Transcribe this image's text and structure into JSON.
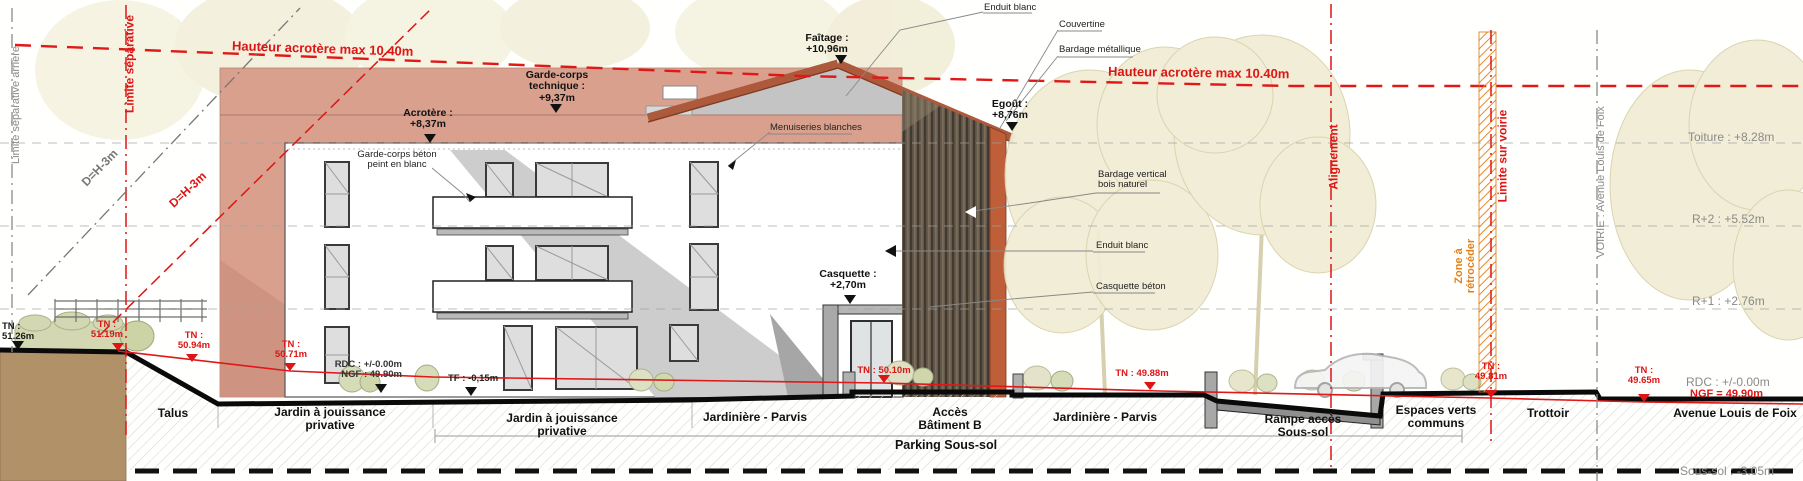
{
  "colors": {
    "red": "#dd1515",
    "orange": "#e0821e",
    "salmon": "#d9a08e",
    "roof": "#ad5a3c",
    "wood_dark": "#5a5043",
    "orange_band": "#bf5f3a",
    "gray_text": "#8a8a8a"
  },
  "boundaries": {
    "limite_separative_arriere": "Limite séparative arrière",
    "limite_separative": "Limite séparative",
    "d_h_3m_gray": "D=H-3m",
    "d_h_3m_red": "D=H-3m",
    "alignement": "Alignement",
    "zone_a_retroceder_l1": "Zone à",
    "zone_a_retroceder_l2": "rétrocéder",
    "limite_sur_voirie": "Limite sur voirie",
    "voirie_axis": "VOIRIE : Avenue Louis de Foix"
  },
  "height_limit": {
    "left": "Hauteur acrotère max 10.40m",
    "right": "Hauteur acrotère max 10.40m"
  },
  "annotations": {
    "faitage_l1": "Faîtage :",
    "faitage_l2": "+10,96m",
    "egout_l1": "Egoût :",
    "egout_l2": "+8,76m",
    "gct_l1": "Garde-corps",
    "gct_l2": "technique  :",
    "gct_l3": "+9,37m",
    "acrotere_l1": "Acrotère :",
    "acrotere_l2": "+8,37m",
    "casquette_l1": "Casquette :",
    "casquette_l2": "+2,70m",
    "gc_beton_l1": "Garde-corps béton",
    "gc_beton_l2": "peint en blanc",
    "menuiseries": "Menuiseries blanches",
    "enduit_blanc_top": "Enduit blanc",
    "couvertine": "Couvertine",
    "bardage_metallique": "Bardage métallique",
    "bardage_vertical_l1": "Bardage vertical",
    "bardage_vertical_l2": "bois naturel",
    "enduit_blanc_mid": "Enduit blanc",
    "casquette_beton": "Casquette béton"
  },
  "levels": {
    "toiture": "Toiture : +8.28m",
    "r2": "R+2 : +5.52m",
    "r1": "R+1 : +2.76m",
    "rdc": "RDC : +/-0.00m",
    "ngf": "NGF = 49.90m",
    "sous_sol": "Sous-sol : -3.05m"
  },
  "terrain": {
    "tn_51_26_l1": "TN :",
    "tn_51_26_l2": "51.26m",
    "tn_51_19_l1": "TN :",
    "tn_51_19_l2": "51.19m",
    "tn_50_94_l1": "TN :",
    "tn_50_94_l2": "50.94m",
    "tn_50_71_l1": "TN :",
    "tn_50_71_l2": "50.71m",
    "rdc_left_l1": "RDC : +/-0.00m",
    "rdc_left_l2": "NGF : 49.90m",
    "tf": "TF : -0,15m",
    "tn_50_10": "TN : 50.10m",
    "tn_49_88": "TN : 49.88m",
    "tn_49_81_l1": "TN :",
    "tn_49_81_l2": "49.81m",
    "tn_49_65_l1": "TN :",
    "tn_49_65_l2": "49.65m"
  },
  "zones": {
    "talus": "Talus",
    "jardin1_l1": "Jardin à jouissance",
    "jardin1_l2": "privative",
    "jardin2_l1": "Jardin à jouissance",
    "jardin2_l2": "privative",
    "jardiniere_parvis_1": "Jardinière - Parvis",
    "acces_l1": "Accès",
    "acces_l2": "Bâtiment B",
    "jardiniere_parvis_2": "Jardinière - Parvis",
    "rampe_l1": "Rampe accès",
    "rampe_l2": "Sous-sol",
    "espaces_l1": "Espaces verts",
    "espaces_l2": "communs",
    "trottoir": "Trottoir",
    "avenue": "Avenue Louis de Foix",
    "parking": "Parking Sous-sol"
  }
}
